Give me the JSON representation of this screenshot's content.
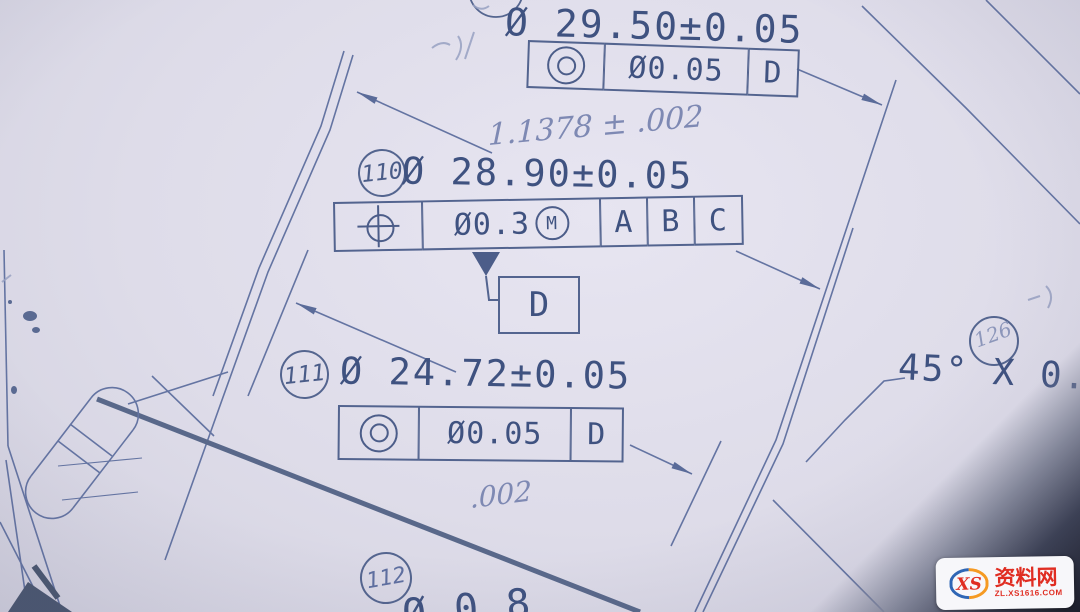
{
  "photo": {
    "paper_color": "#dedce9",
    "ink_color": "#3f5280",
    "pencil_color": "#7e89b3",
    "watermark_red": "#e02d22"
  },
  "symbols": {
    "concentricity_icon": "◎",
    "position_icon": "⌖",
    "mmc_icon": "Ⓜ",
    "datum_triangle_icon": "▼",
    "diameter_sign": "Ø"
  },
  "callout_top": {
    "dimension": "Ø 29.50±0.05",
    "fcf": {
      "tolerance": "Ø0.05",
      "datum": "D"
    }
  },
  "handwritten": {
    "inch_dimension": "1.1378 ± .002",
    "inch_tolerance": ".002"
  },
  "callout_110": {
    "balloon": "110",
    "dimension": "Ø 28.90±0.05",
    "fcf": {
      "tolerance": "Ø0.3",
      "modifier": "M",
      "datum_a": "A",
      "datum_b": "B",
      "datum_c": "C"
    }
  },
  "datum_flag": {
    "label": "D"
  },
  "callout_111": {
    "balloon": "111",
    "dimension": "Ø 24.72±0.05",
    "fcf": {
      "tolerance": "Ø0.05",
      "datum": "D"
    }
  },
  "callout_112": {
    "balloon": "112",
    "dimension_partial": "Ø 0.8"
  },
  "chamfer": {
    "balloon": "126",
    "text": "45° X 0."
  },
  "watermark": {
    "logo_text": "XS",
    "name": "资料网",
    "url": "ZL.XS1616.COM"
  }
}
